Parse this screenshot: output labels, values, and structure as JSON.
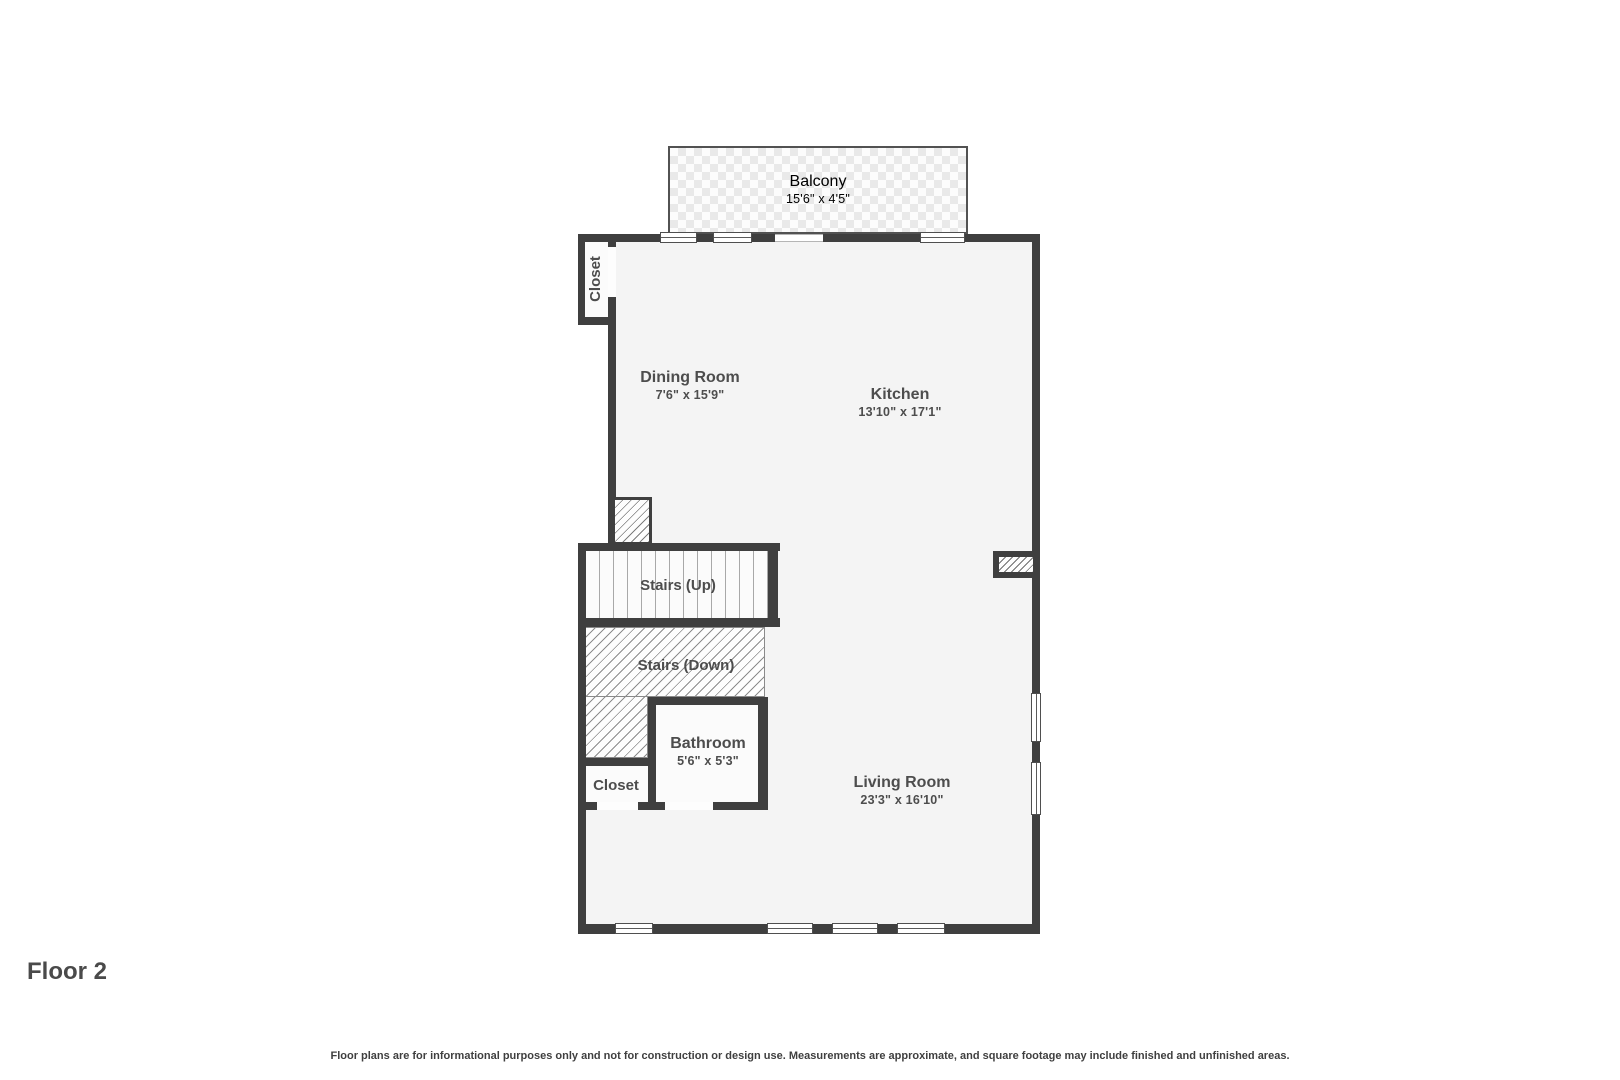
{
  "footer": {
    "title": "Floor 2",
    "disclaimer": "Floor plans are for informational purposes only and not for construction or design use. Measurements are approximate, and square footage may include finished and unfinished areas."
  },
  "rooms": {
    "balcony": {
      "name": "Balcony",
      "dims": "15'6\" x 4'5\""
    },
    "closet_top": {
      "name": "Closet"
    },
    "dining": {
      "name": "Dining Room",
      "dims": "7'6\" x 15'9\""
    },
    "kitchen": {
      "name": "Kitchen",
      "dims": "13'10\" x 17'1\""
    },
    "stairs_up": {
      "name": "Stairs (Up)"
    },
    "stairs_down": {
      "name": "Stairs (Down)"
    },
    "bathroom": {
      "name": "Bathroom",
      "dims": "5'6\" x 5'3\""
    },
    "closet_bottom": {
      "name": "Closet"
    },
    "living": {
      "name": "Living Room",
      "dims": "23'3\" x 16'10\""
    }
  },
  "colors": {
    "wall": "#3f3f3f",
    "floor": "#f4f4f4",
    "text": "#4d4d4d"
  }
}
